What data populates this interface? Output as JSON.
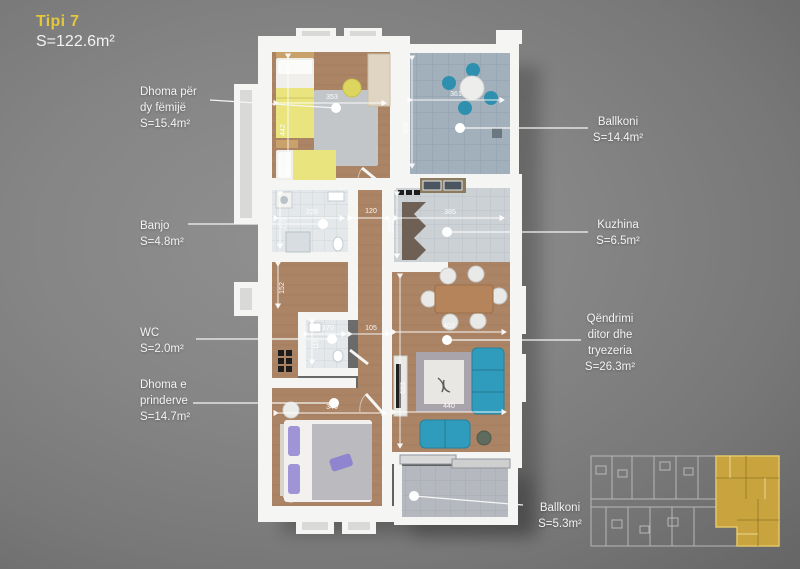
{
  "title": {
    "label": "Tipi 7",
    "area": "S=122.6m²"
  },
  "labels": {
    "children": {
      "name": "Dhoma për\ndy fëmijë",
      "area": "S=15.4m²"
    },
    "bath": {
      "name": "Banjo",
      "area": "S=4.8m²"
    },
    "wc": {
      "name": "WC",
      "area": "S=2.0m²"
    },
    "parents": {
      "name": "Dhoma e\nprinderve",
      "area": "S=14.7m²"
    },
    "balcony_top": {
      "name": "Ballkoni",
      "area": "S=14.4m²"
    },
    "kitchen": {
      "name": "Kuzhina",
      "area": "S=6.5m²"
    },
    "living": {
      "name": "Qëndrimi\nditor dhe\ntryezeria",
      "area": "S=26.3m²"
    },
    "balcony_bottom": {
      "name": "Ballkoni",
      "area": "S=5.3m²"
    }
  },
  "dims": {
    "children_w": "353",
    "children_h": "442",
    "balcony_w": "361",
    "balcony_h": "398",
    "kitchen_w": "385",
    "kitchen_h": "203",
    "bath_w": "228",
    "bath_h": "210",
    "hall_w": "120",
    "hall_h": "152",
    "wc_w": "170",
    "wc_h": "118",
    "wc_gap": "105",
    "living_w": "402",
    "living_w2": "440",
    "living_h": "623",
    "parents_w": "340"
  },
  "colors": {
    "accent_yellow": "#e5c73d",
    "wall_white": "#f5f5f4",
    "wood_floor": "#ab8465",
    "balcony_tile": "#a2b0bc",
    "sofa_teal": "#2f9cbd",
    "bed_yellow": "#e9e47e",
    "minimap_highlight": "#c9a43e"
  }
}
